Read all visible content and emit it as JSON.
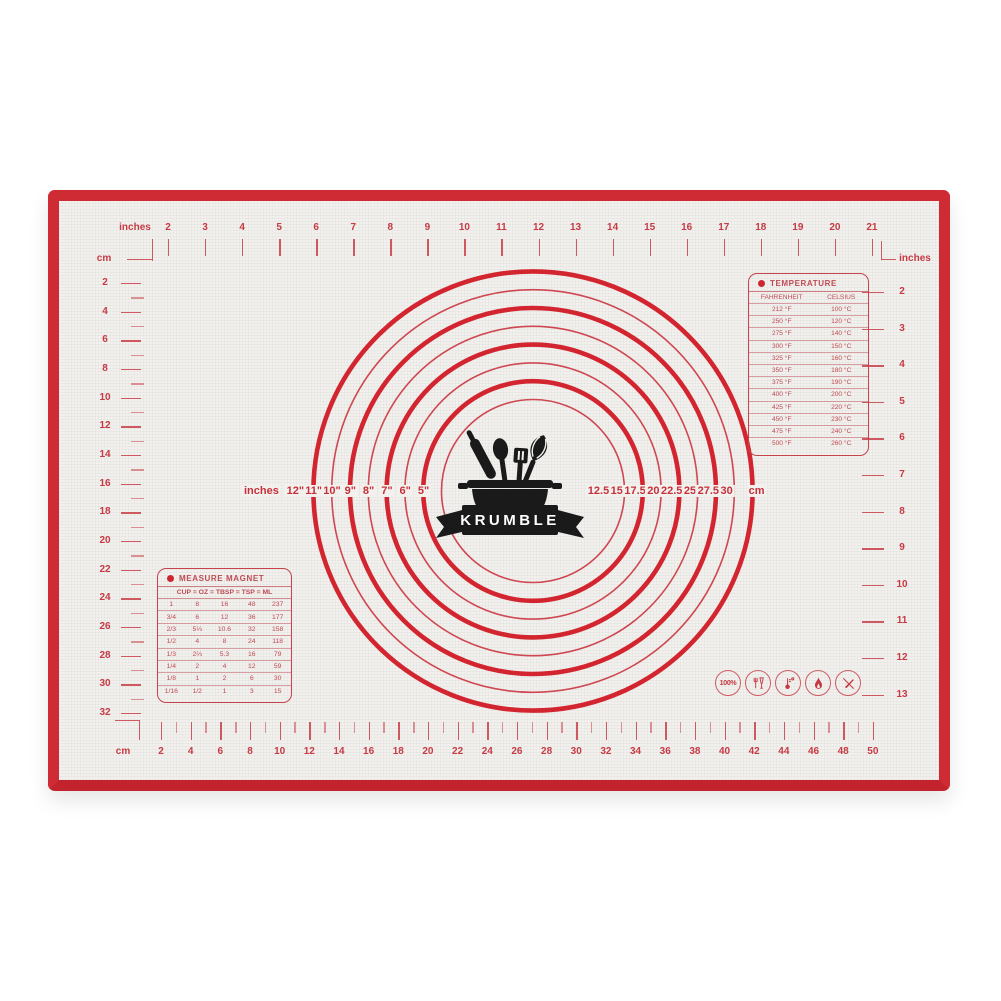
{
  "brand": {
    "name": "KRUMBLE"
  },
  "colors": {
    "border_red": "#cf2b34",
    "print_red": "#c73a43",
    "surface": "#f2f1ee",
    "logo_black": "#1a1a1a"
  },
  "top_ruler": {
    "unit_label": "inches",
    "corner_unit": "cm",
    "end_unit": "inches",
    "numbers": [
      "2",
      "3",
      "4",
      "5",
      "6",
      "7",
      "8",
      "9",
      "10",
      "11",
      "12",
      "13",
      "14",
      "15",
      "16",
      "17",
      "18",
      "19",
      "20",
      "21"
    ]
  },
  "left_ruler": {
    "numbers": [
      "2",
      "4",
      "6",
      "8",
      "10",
      "12",
      "14",
      "16",
      "18",
      "20",
      "22",
      "24",
      "26",
      "28",
      "30",
      "32"
    ]
  },
  "right_ruler": {
    "unit_label": "inches",
    "numbers": [
      "2",
      "3",
      "4",
      "5",
      "6",
      "7",
      "8",
      "9",
      "10",
      "11",
      "12",
      "13"
    ]
  },
  "bottom_ruler": {
    "unit_label": "cm",
    "numbers": [
      "2",
      "4",
      "6",
      "8",
      "10",
      "12",
      "14",
      "16",
      "18",
      "20",
      "22",
      "24",
      "26",
      "28",
      "30",
      "32",
      "34",
      "36",
      "38",
      "40",
      "42",
      "44",
      "46",
      "48",
      "50"
    ]
  },
  "circles": {
    "left_unit": "inches",
    "left_labels": [
      "12\"",
      "11\"",
      "10\"",
      "9\"",
      "8\"",
      "7\"",
      "6\"",
      "5\""
    ],
    "right_labels": [
      "12.5",
      "15",
      "17.5",
      "20",
      "22.5",
      "25",
      "27.5",
      "30"
    ],
    "right_unit": "cm"
  },
  "temperature_table": {
    "title": "TEMPERATURE",
    "columns": [
      "FAHRENHEIT",
      "CELSIUS"
    ],
    "rows": [
      [
        "212 °F",
        "100 °C"
      ],
      [
        "250 °F",
        "120 °C"
      ],
      [
        "275 °F",
        "140 °C"
      ],
      [
        "300 °F",
        "150 °C"
      ],
      [
        "325 °F",
        "160 °C"
      ],
      [
        "350 °F",
        "180 °C"
      ],
      [
        "375 °F",
        "190 °C"
      ],
      [
        "400 °F",
        "200 °C"
      ],
      [
        "425 °F",
        "220 °C"
      ],
      [
        "450 °F",
        "230 °C"
      ],
      [
        "475 °F",
        "240 °C"
      ],
      [
        "500 °F",
        "260 °C"
      ]
    ]
  },
  "measure_table": {
    "title": "MEASURE MAGNET",
    "header": "CUP = OZ = TBSP = TSP = ML",
    "rows": [
      [
        "1",
        "8",
        "16",
        "48",
        "237"
      ],
      [
        "3/4",
        "6",
        "12",
        "36",
        "177"
      ],
      [
        "2/3",
        "5⅓",
        "10.6",
        "32",
        "158"
      ],
      [
        "1/2",
        "4",
        "8",
        "24",
        "118"
      ],
      [
        "1/3",
        "2⅔",
        "5.3",
        "16",
        "79"
      ],
      [
        "1/4",
        "2",
        "4",
        "12",
        "59"
      ],
      [
        "1/8",
        "1",
        "2",
        "6",
        "30"
      ],
      [
        "1/16",
        "1/2",
        "1",
        "3",
        "15"
      ]
    ]
  },
  "feature_icons": [
    {
      "name": "100-percent-icon",
      "label": "100%"
    },
    {
      "name": "food-safe-icon",
      "label": ""
    },
    {
      "name": "thermometer-icon",
      "label": ""
    },
    {
      "name": "flame-icon",
      "label": ""
    },
    {
      "name": "no-knife-icon",
      "label": ""
    }
  ]
}
